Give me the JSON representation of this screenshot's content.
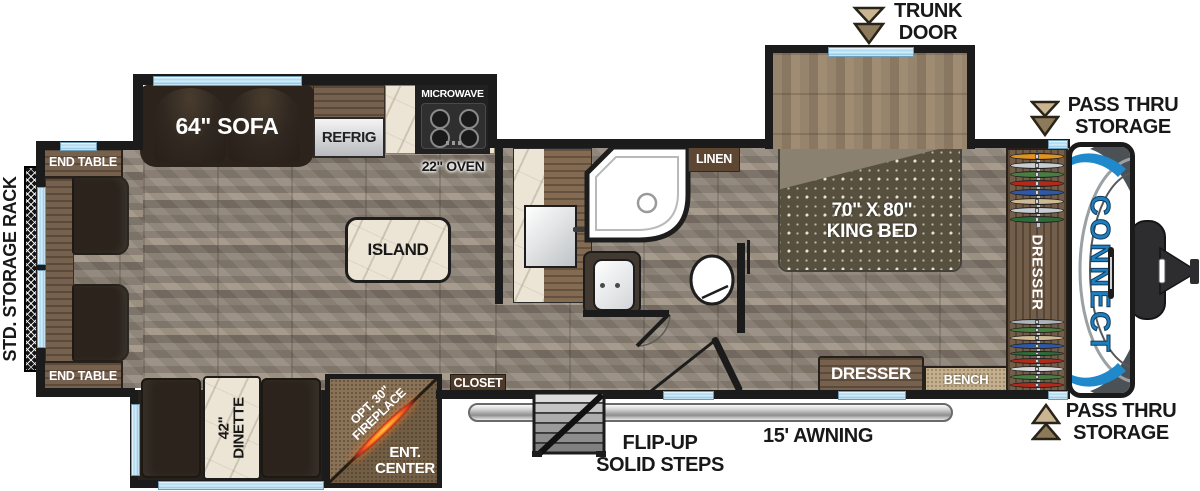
{
  "exterior": {
    "storage_rack": "STD. STORAGE RACK",
    "trunk_door": [
      "TRUNK",
      "DOOR"
    ],
    "pass_thru_top": [
      "PASS THRU",
      "STORAGE"
    ],
    "pass_thru_bottom": [
      "PASS THRU",
      "STORAGE"
    ],
    "awning": "15' AWNING",
    "steps": [
      "FLIP-UP",
      "SOLID STEPS"
    ]
  },
  "living": {
    "sofa": "64\" SOFA",
    "end_table_top": "END TABLE",
    "end_table_bottom": "END TABLE",
    "dinette": [
      "42\"",
      "DINETTE"
    ],
    "fireplace": [
      "OPT. 30\"",
      "FIREPLACE"
    ],
    "ent_center": [
      "ENT.",
      "CENTER"
    ]
  },
  "kitchen": {
    "refrig": "REFRIG",
    "microwave": "MICROWAVE",
    "oven": "22\" OVEN",
    "island": "ISLAND",
    "closet": "CLOSET"
  },
  "bath": {
    "linen": "LINEN"
  },
  "bedroom": {
    "bed": [
      "70\" X 80\"",
      "KING BED"
    ],
    "dresser_bottom": "DRESSER",
    "bench": "BENCH",
    "dresser_side": "DRESSER"
  },
  "brand": {
    "logo": "CONNECT"
  },
  "wardrobes": {
    "top_colors": [
      "#e2921f",
      "#c9cdd1",
      "#4a7d42",
      "#b22a1c",
      "#2f58a7",
      "#cdb994",
      "#c9cdd1",
      "#2f6b3a"
    ],
    "bottom_colors": [
      "#aeb4b9",
      "#4a7d42",
      "#cdb994",
      "#2f58a7",
      "#2f6b3a",
      "#b22a1c",
      "#d9d9d9",
      "#4a7d42",
      "#b22a1c"
    ]
  },
  "colors": {
    "wall": "#1b1b1b",
    "accent_blue": "#1e7fc0",
    "window_blue": "#a9d8ef",
    "flame_orange": "#ff7e1c"
  }
}
